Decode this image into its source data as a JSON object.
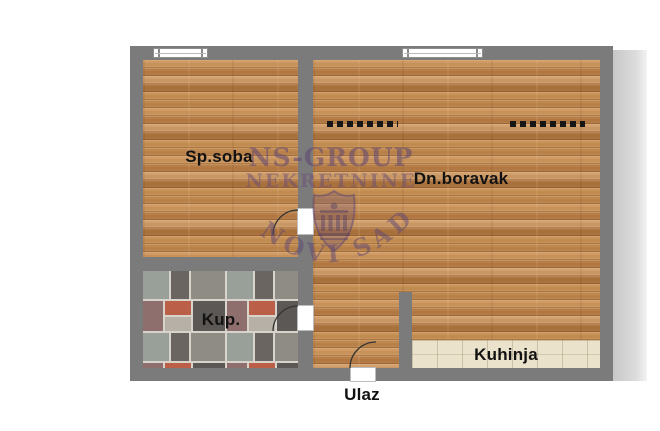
{
  "plan": {
    "type": "apartment-floor-plan"
  },
  "rooms": {
    "bedroom": {
      "label": "Sp.soba"
    },
    "living_room": {
      "label": "Dn.boravak"
    },
    "bathroom": {
      "label": "Kup."
    },
    "kitchen": {
      "label": "Kuhinja"
    },
    "entrance": {
      "label": "Ulaz"
    }
  },
  "watermark": {
    "line1": "NS-GROUP",
    "line2": "NEKRETNINE",
    "arc_text": "NOVI SAD"
  },
  "icons": {
    "window": "double-frame-window-symbol",
    "door": "quarter-circle-swing-arc",
    "beam": "dashed-ceiling-line",
    "shield": "ns-group-crest"
  },
  "colors": {
    "wall": "#7b7b7b",
    "wood_floor": "#c18a53",
    "kitchen_tile": "#ebe2cc",
    "bathroom_grout": "#d8d3cb",
    "watermark": "#5e4672",
    "label_text": "#121212",
    "background": "#ffffff",
    "shadow": "#b5b5b5"
  }
}
